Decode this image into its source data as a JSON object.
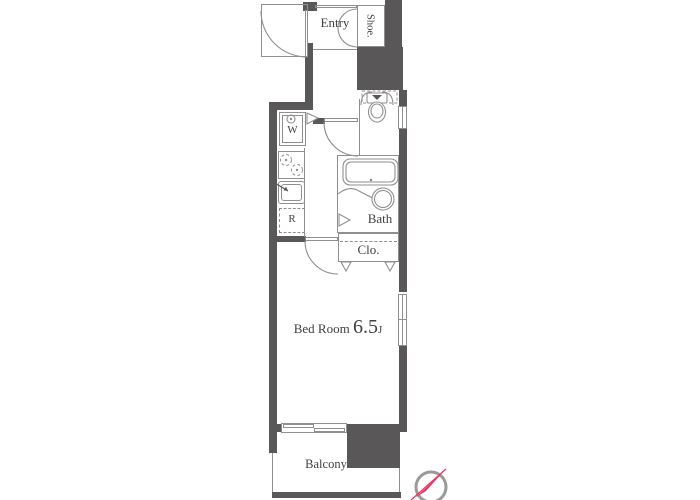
{
  "meta": {
    "drawing_type": "apartment floor plan"
  },
  "colors": {
    "wall": "#595757",
    "line": "#8f8f8f",
    "thin": "#9a9a9a",
    "text": "#3f3f3f",
    "compass_red": "#e8335f",
    "bg": "#ffffff"
  },
  "rooms": {
    "entry": {
      "label": "Entry"
    },
    "shoe": {
      "label": "Shoe."
    },
    "washer": {
      "label": "W"
    },
    "fridge": {
      "label": "R"
    },
    "bath": {
      "label": "Bath"
    },
    "closet": {
      "label": "Clo."
    },
    "bedroom": {
      "name": "Bed Room",
      "size": "6.5",
      "size_unit": "J"
    },
    "balcony": {
      "label": "Balcony"
    }
  }
}
